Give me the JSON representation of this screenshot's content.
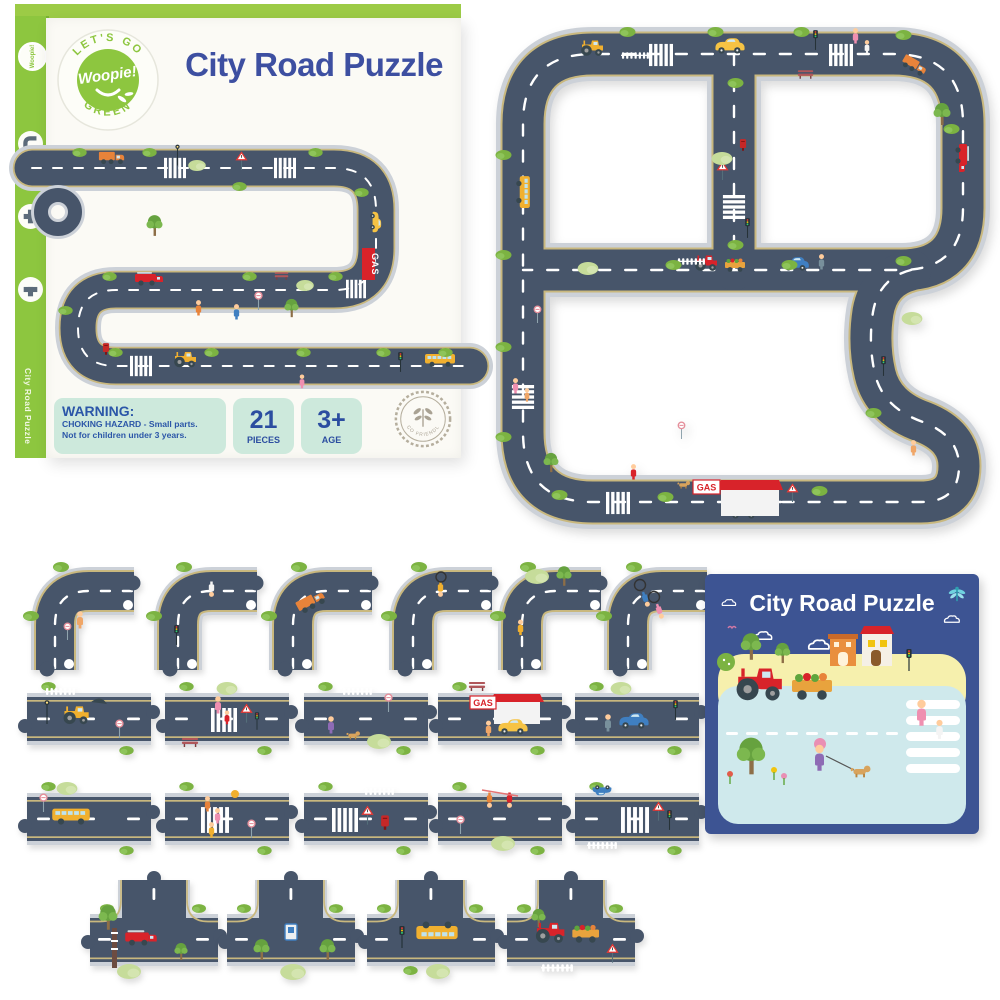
{
  "box": {
    "brand": {
      "arc_top": "LET'S GO",
      "name": "Woopie!",
      "arc_bottom": "GREEN"
    },
    "title": "City Road Puzzle",
    "spine_title": "City Road Puzzle",
    "warning": {
      "heading": "WARNING:",
      "line1": "CHOKING HAZARD - Small parts.",
      "line2": "Not for children under 3 years."
    },
    "badges": {
      "pieces": {
        "value": "21",
        "label": "PIECES"
      },
      "age": {
        "value": "3+",
        "label": "AGE"
      }
    },
    "eco_stamp": "ECO FRIENDLY",
    "gas_sign": "GAS"
  },
  "puzzle": {
    "gas_sign": "GAS",
    "description": "Assembled city road puzzle track with cars, crossings, gas station and greenery"
  },
  "booklet": {
    "title": "City Road Puzzle"
  },
  "pieces": {
    "row1": [
      {
        "type": "corner",
        "content": "curved road with toddler holding round sign"
      },
      {
        "type": "corner",
        "content": "curved road with traffic light and child"
      },
      {
        "type": "corner",
        "content": "curved road with orange delivery truck"
      },
      {
        "type": "corner",
        "content": "curved road with child cyclist"
      },
      {
        "type": "corner",
        "content": "curved road with tall tree and girl"
      },
      {
        "type": "corner",
        "content": "curved road with two kids on bicycles"
      }
    ],
    "row2": [
      {
        "type": "straight",
        "content": "straight road with yellow digger, street lamp and fence"
      },
      {
        "type": "straight",
        "content": "straight road with zebra crossing, mother and child, warning sign and bench"
      },
      {
        "type": "straight",
        "content": "straight road with girl walking a dog past bushes"
      },
      {
        "type": "straight",
        "content": "straight road with GAS station and yellow car"
      },
      {
        "type": "straight",
        "content": "straight road with blue car, driver and traffic light"
      }
    ],
    "row3": [
      {
        "type": "straight",
        "content": "straight road with yellow school bus"
      },
      {
        "type": "straight",
        "content": "straight road with family on zebra crossing"
      },
      {
        "type": "straight",
        "content": "straight road with zebra crossing, warning sign and red postbox"
      },
      {
        "type": "straight",
        "content": "straight road with playing kids and round sign"
      },
      {
        "type": "straight",
        "content": "straight road with zebra crossing, traffic light and warning sign"
      }
    ],
    "row4": [
      {
        "type": "tee",
        "content": "T-junction with red fire truck, ladder and tree"
      },
      {
        "type": "tee",
        "content": "T-junction with bus stop sign and trees"
      },
      {
        "type": "tee",
        "content": "T-junction with school bus full of kids and traffic light"
      },
      {
        "type": "tee",
        "content": "T-junction with red tractor towing vegetable trailer, fence and yield sign"
      }
    ]
  },
  "colors": {
    "brand_green": "#8dc63f",
    "title_blue": "#3d4fa1",
    "mint": "#cde9dc",
    "badge_text_blue": "#2b4da0",
    "road": "#47556a",
    "road_casing": "#ccd1d8",
    "road_edge_line": "#c9b87e",
    "bush_green": "#7cb342",
    "booklet_blue": "#3d5493",
    "gas_red": "#d8232a"
  }
}
